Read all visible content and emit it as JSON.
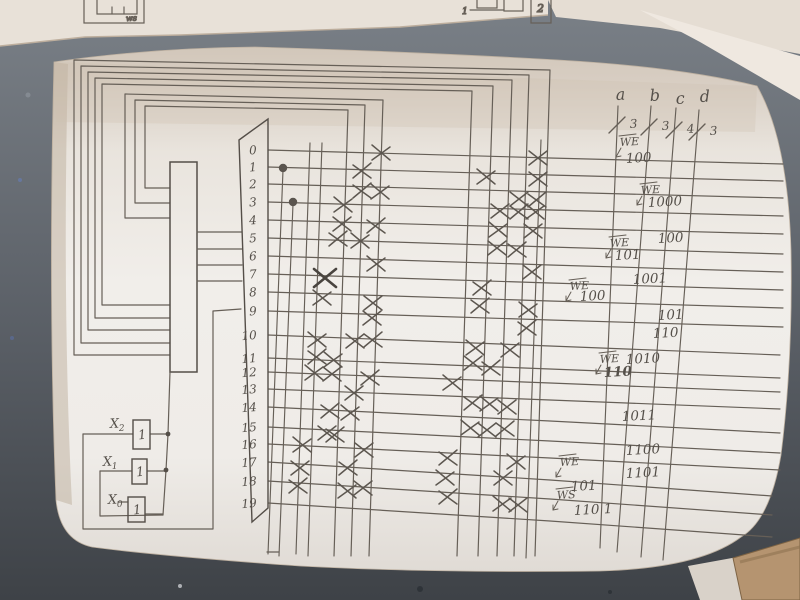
{
  "scene": {
    "desk_color_top": "#7a8087",
    "desk_color_mid": "#5a5f66",
    "desk_color_bottom": "#3e4247",
    "paper_main_light": "#f1eeea",
    "paper_main_tan": "#d2c7ba",
    "paper_top_sheet": "#e8e1d8",
    "paper_tr_sheet1": "#e5ddd3",
    "paper_tr_sheet2": "#efe8e0",
    "pencil": "#665f57",
    "pencil_dark": "#544e48",
    "tan_object": "#b59470",
    "scrap_white": "#d9d2c9"
  },
  "top_sheet_fragments": {
    "left_box_label": "ws",
    "mid_wire_label": "1",
    "mid_box_label": "2"
  },
  "diagram": {
    "title_hint": "hand-drawn decoder / ROM crosspoint matrix",
    "decoder": {
      "x": 170,
      "y": 162,
      "w": 27,
      "h": 210
    },
    "driver_trapezoid": {
      "points": "239,140 268,119 268,508 252,522"
    },
    "rows": {
      "labels": [
        "0",
        "1",
        "2",
        "3",
        "4",
        "5",
        "6",
        "7",
        "8",
        "9",
        "10",
        "11",
        "12",
        "13",
        "14",
        "15",
        "16",
        "17",
        "18",
        "19"
      ],
      "y": [
        150,
        167,
        184,
        202,
        220,
        238,
        256,
        274,
        292,
        311,
        335,
        358,
        372,
        389,
        407,
        427,
        444,
        462,
        481,
        503
      ],
      "x_start": 268,
      "label_x": 257
    },
    "row_slopes": {
      "s1": [
        8,
        8,
        8,
        8,
        8,
        9,
        9,
        9,
        9,
        9,
        11,
        11,
        11,
        11,
        14,
        14,
        14,
        18,
        18,
        18
      ],
      "s2": [
        6,
        6,
        6,
        6,
        6,
        7,
        7,
        7,
        7,
        7,
        9,
        9,
        9,
        9,
        12,
        12,
        12,
        16,
        16,
        16
      ],
      "x_mid": 550,
      "x_end": [
        783,
        783,
        783,
        783,
        783,
        783,
        783,
        783,
        783,
        783,
        780,
        780,
        780,
        780,
        780,
        780,
        780,
        772,
        772,
        772
      ]
    },
    "nested_bus_lines": [
      {
        "B": 355,
        "L": 74,
        "T": 60,
        "T2": 70,
        "D": 550,
        "Db": 535
      },
      {
        "B": 343,
        "L": 81,
        "T": 66,
        "T2": 75,
        "D": 529,
        "Db": 514
      },
      {
        "B": 330,
        "L": 88,
        "T": 72,
        "T2": 80,
        "D": 512,
        "Db": 497
      },
      {
        "B": 318,
        "L": 95,
        "T": 78,
        "T2": 86,
        "D": 493,
        "Db": 478
      },
      {
        "B": 305,
        "L": 102,
        "T": 84,
        "T2": 91,
        "D": 472,
        "Db": 457
      },
      {
        "B": 218,
        "L": 125,
        "T": 94,
        "T2": 100,
        "D": 383,
        "Db": 369
      },
      {
        "B": 203,
        "L": 135,
        "T": 100,
        "T2": 105,
        "D": 365,
        "Db": 351
      },
      {
        "B": 188,
        "L": 145,
        "T": 106,
        "T2": 110,
        "D": 348,
        "Db": 334
      }
    ],
    "extra_verticals": [
      [
        283,
        170,
        268,
        554
      ],
      [
        293,
        204,
        279,
        556
      ],
      [
        310,
        143,
        296,
        554
      ],
      [
        322,
        143,
        308,
        556
      ],
      [
        541,
        140,
        526,
        558
      ]
    ],
    "decoder_stubs": [
      [
        197,
        232,
        242,
        232
      ],
      [
        197,
        249,
        242,
        249
      ],
      [
        197,
        265,
        242,
        265
      ],
      [
        197,
        281,
        242,
        281
      ]
    ],
    "wires": [
      [
        [
          170,
          372
        ],
        [
          168,
          434
        ],
        [
          166,
          470
        ],
        [
          163,
          515
        ]
      ],
      [
        [
          83,
          434
        ],
        [
          133,
          434
        ]
      ],
      [
        [
          83,
          434
        ],
        [
          83,
          529
        ],
        [
          213,
          529
        ],
        [
          213,
          311
        ],
        [
          241,
          309
        ]
      ],
      [
        [
          100,
          471
        ],
        [
          132,
          471
        ]
      ],
      [
        [
          100,
          471
        ],
        [
          100,
          516
        ],
        [
          163,
          515
        ]
      ],
      [
        [
          118,
          502
        ],
        [
          128,
          502
        ]
      ],
      [
        [
          150,
          434
        ],
        [
          168,
          434
        ]
      ],
      [
        [
          147,
          471
        ],
        [
          166,
          471
        ]
      ],
      [
        [
          145,
          514
        ],
        [
          163,
          514
        ]
      ],
      [
        [
          267,
          552
        ],
        [
          279,
          552
        ]
      ]
    ],
    "wire_dots": [
      [
        168,
        434
      ],
      [
        166,
        470
      ]
    ],
    "row_dots": [
      [
        283,
        168
      ],
      [
        293,
        202
      ]
    ],
    "marks": [
      [
        381,
        153
      ],
      [
        538,
        158
      ],
      [
        362,
        171
      ],
      [
        486,
        177
      ],
      [
        538,
        179
      ],
      [
        362,
        191
      ],
      [
        380,
        192
      ],
      [
        519,
        199
      ],
      [
        537,
        200
      ],
      [
        343,
        205
      ],
      [
        500,
        211
      ],
      [
        519,
        212
      ],
      [
        535,
        212
      ],
      [
        342,
        224
      ],
      [
        376,
        226
      ],
      [
        498,
        230
      ],
      [
        533,
        231
      ],
      [
        338,
        239
      ],
      [
        360,
        241
      ],
      [
        497,
        248
      ],
      [
        517,
        250
      ],
      [
        376,
        264
      ],
      [
        532,
        272
      ],
      [
        482,
        288
      ],
      [
        322,
        298
      ],
      [
        373,
        303
      ],
      [
        480,
        306
      ],
      [
        528,
        310
      ],
      [
        372,
        318
      ],
      [
        527,
        328
      ],
      [
        317,
        340
      ],
      [
        355,
        341
      ],
      [
        373,
        340
      ],
      [
        475,
        348
      ],
      [
        510,
        350
      ],
      [
        317,
        357
      ],
      [
        333,
        360
      ],
      [
        473,
        363
      ],
      [
        491,
        368
      ],
      [
        314,
        373
      ],
      [
        332,
        374
      ],
      [
        370,
        378
      ],
      [
        452,
        383
      ],
      [
        354,
        393
      ],
      [
        473,
        403
      ],
      [
        489,
        404
      ],
      [
        507,
        407
      ],
      [
        330,
        411
      ],
      [
        350,
        413
      ],
      [
        327,
        433
      ],
      [
        335,
        435
      ],
      [
        470,
        428
      ],
      [
        487,
        430
      ],
      [
        505,
        429
      ],
      [
        302,
        445
      ],
      [
        364,
        450
      ],
      [
        448,
        458
      ],
      [
        516,
        462
      ],
      [
        300,
        468
      ],
      [
        348,
        468
      ],
      [
        445,
        478
      ],
      [
        503,
        478
      ],
      [
        298,
        486
      ],
      [
        347,
        491
      ],
      [
        363,
        488
      ],
      [
        448,
        497
      ],
      [
        502,
        504
      ],
      [
        518,
        505
      ]
    ],
    "bold_mark": [
      325,
      278
    ],
    "output_buses": {
      "labels": [
        "a",
        "b",
        "c",
        "d"
      ],
      "widths": [
        "3",
        "3",
        "4",
        "3"
      ],
      "lines": [
        [
          618,
          106,
          600,
          548
        ],
        [
          651,
          106,
          617,
          552
        ],
        [
          676,
          108,
          641,
          557
        ],
        [
          699,
          110,
          663,
          560
        ]
      ],
      "label_pos": [
        [
          616,
          100
        ],
        [
          650,
          101
        ],
        [
          676,
          104
        ],
        [
          700,
          102
        ]
      ],
      "slash_pos": [
        [
          617,
          125
        ],
        [
          649,
          127
        ],
        [
          674,
          130
        ],
        [
          697,
          132
        ]
      ],
      "width_pos": [
        [
          630,
          128
        ],
        [
          662,
          130
        ],
        [
          687,
          133
        ],
        [
          710,
          135
        ]
      ]
    },
    "gates": [
      {
        "x": 133,
        "y": 420,
        "w": 17,
        "h": 29,
        "glyph": "1",
        "label": "X",
        "sub": "2",
        "lx": 110,
        "ly": 428
      },
      {
        "x": 132,
        "y": 459,
        "w": 15,
        "h": 25,
        "glyph": "1",
        "label": "X",
        "sub": "1",
        "lx": 103,
        "ly": 466
      },
      {
        "x": 128,
        "y": 497,
        "w": 17,
        "h": 25,
        "glyph": "1",
        "label": "X",
        "sub": "0",
        "lx": 108,
        "ly": 504
      }
    ],
    "annotations": [
      {
        "t": "WE",
        "x": 620,
        "y": 146,
        "bar": true,
        "arrow": true
      },
      {
        "t": "100",
        "x": 626,
        "y": 163
      },
      {
        "t": "WE",
        "x": 641,
        "y": 194,
        "bar": true,
        "arrow": true
      },
      {
        "t": "1000",
        "x": 648,
        "y": 207
      },
      {
        "t": "100",
        "x": 658,
        "y": 243
      },
      {
        "t": "WE",
        "x": 610,
        "y": 247,
        "bar": true,
        "arrow": true
      },
      {
        "t": "101",
        "x": 615,
        "y": 260
      },
      {
        "t": "1001",
        "x": 633,
        "y": 284
      },
      {
        "t": "WE",
        "x": 570,
        "y": 290,
        "bar": true,
        "arrow": true
      },
      {
        "t": "100",
        "x": 580,
        "y": 301
      },
      {
        "t": "101",
        "x": 658,
        "y": 320
      },
      {
        "t": "110",
        "x": 653,
        "y": 338
      },
      {
        "t": "WE",
        "x": 600,
        "y": 363,
        "bar": true,
        "arrow": true
      },
      {
        "t": "1010",
        "x": 626,
        "y": 364
      },
      {
        "t": "110",
        "x": 604,
        "y": 377,
        "bold": true
      },
      {
        "t": "1011",
        "x": 622,
        "y": 421
      },
      {
        "t": "1100",
        "x": 626,
        "y": 455
      },
      {
        "t": "WE",
        "x": 560,
        "y": 466,
        "bar": true,
        "arrow": true
      },
      {
        "t": "1101",
        "x": 626,
        "y": 478
      },
      {
        "t": "101",
        "x": 571,
        "y": 491
      },
      {
        "t": "WS",
        "x": 557,
        "y": 499,
        "bar": true,
        "arrow": true
      },
      {
        "t": "110 1",
        "x": 574,
        "y": 515
      }
    ]
  }
}
